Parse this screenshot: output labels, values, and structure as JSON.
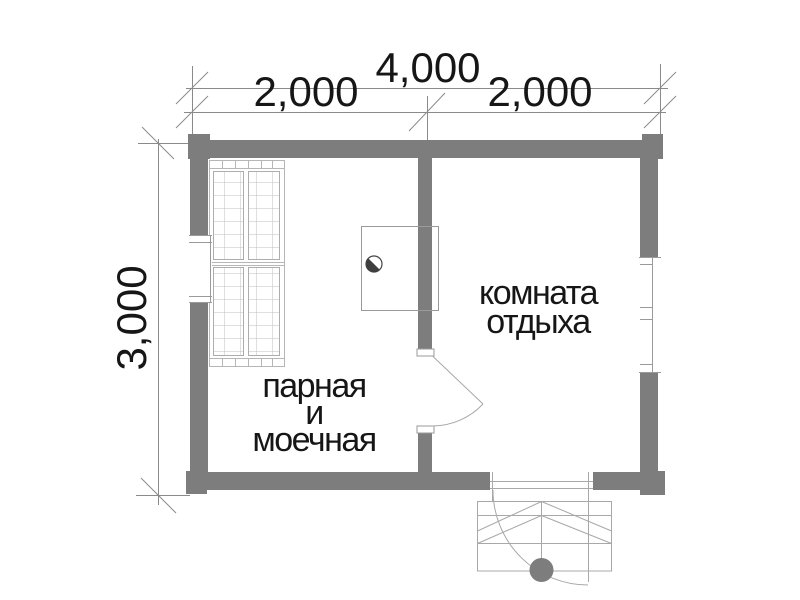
{
  "drawing": {
    "kind": "bath-house floor plan",
    "dimensions": {
      "overall_width": "4,000",
      "left_bay": "2,000",
      "right_bay": "2,000",
      "depth": "3,000"
    },
    "rooms": {
      "steam_washing": {
        "line1": "парная",
        "line2": "и",
        "line3": "моечная"
      },
      "rest": {
        "line1": "комната",
        "line2": "отдыха"
      }
    },
    "features": {
      "bench": "slatted benches (left room)",
      "stove": "stove with survey-style half-filled circle marker",
      "interior_door": "door swinging into rest room",
      "entrance": "entrance door with porch steps and round post"
    }
  },
  "colors": {
    "wall": "#7d7d7d",
    "thin": "#a8a8a8",
    "dim": "#8a8a8a",
    "frame": "#9a9a9a",
    "bench": "#b6b6b6",
    "text": "#161616",
    "marker": "#3f3f3f",
    "bg": "#ffffff"
  }
}
